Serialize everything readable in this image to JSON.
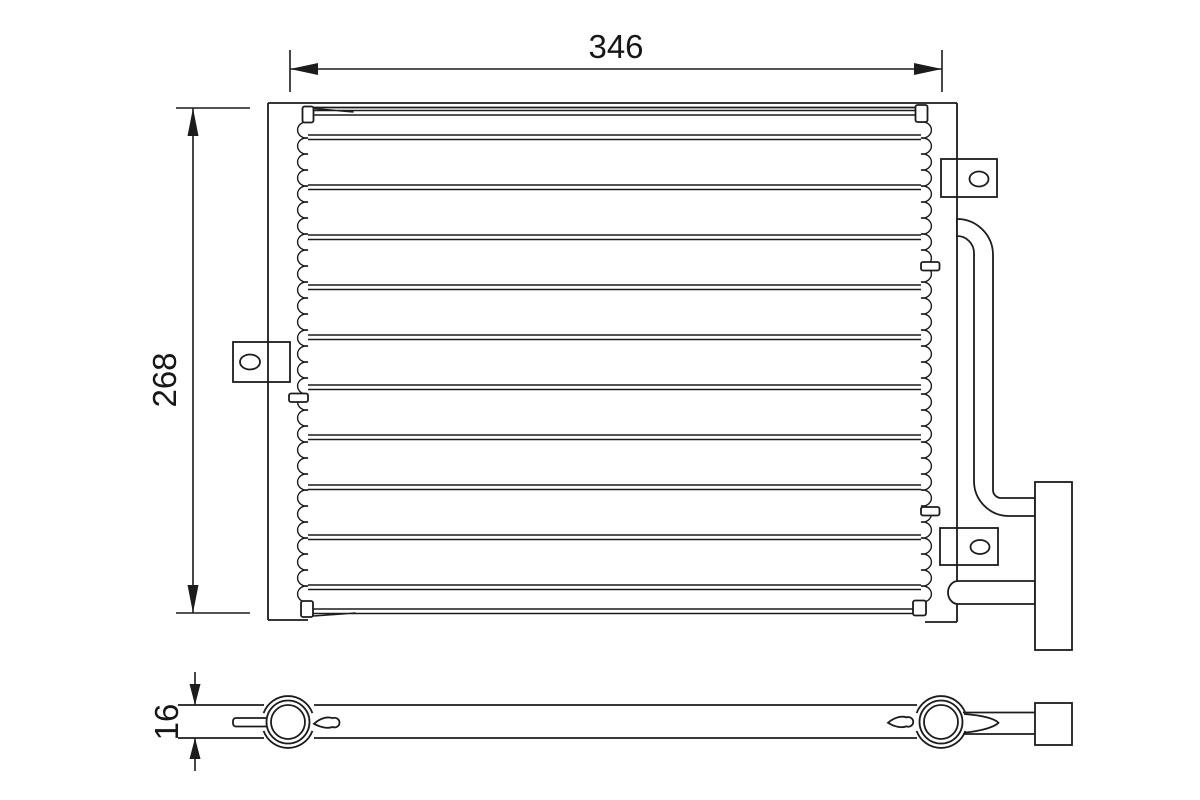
{
  "diagram": {
    "description": "condenser-technical-drawing",
    "dimensions": {
      "width": "346",
      "height": "268",
      "thickness": "16"
    },
    "colors": {
      "line": "#1c1c1c",
      "background": "#ffffff"
    }
  }
}
